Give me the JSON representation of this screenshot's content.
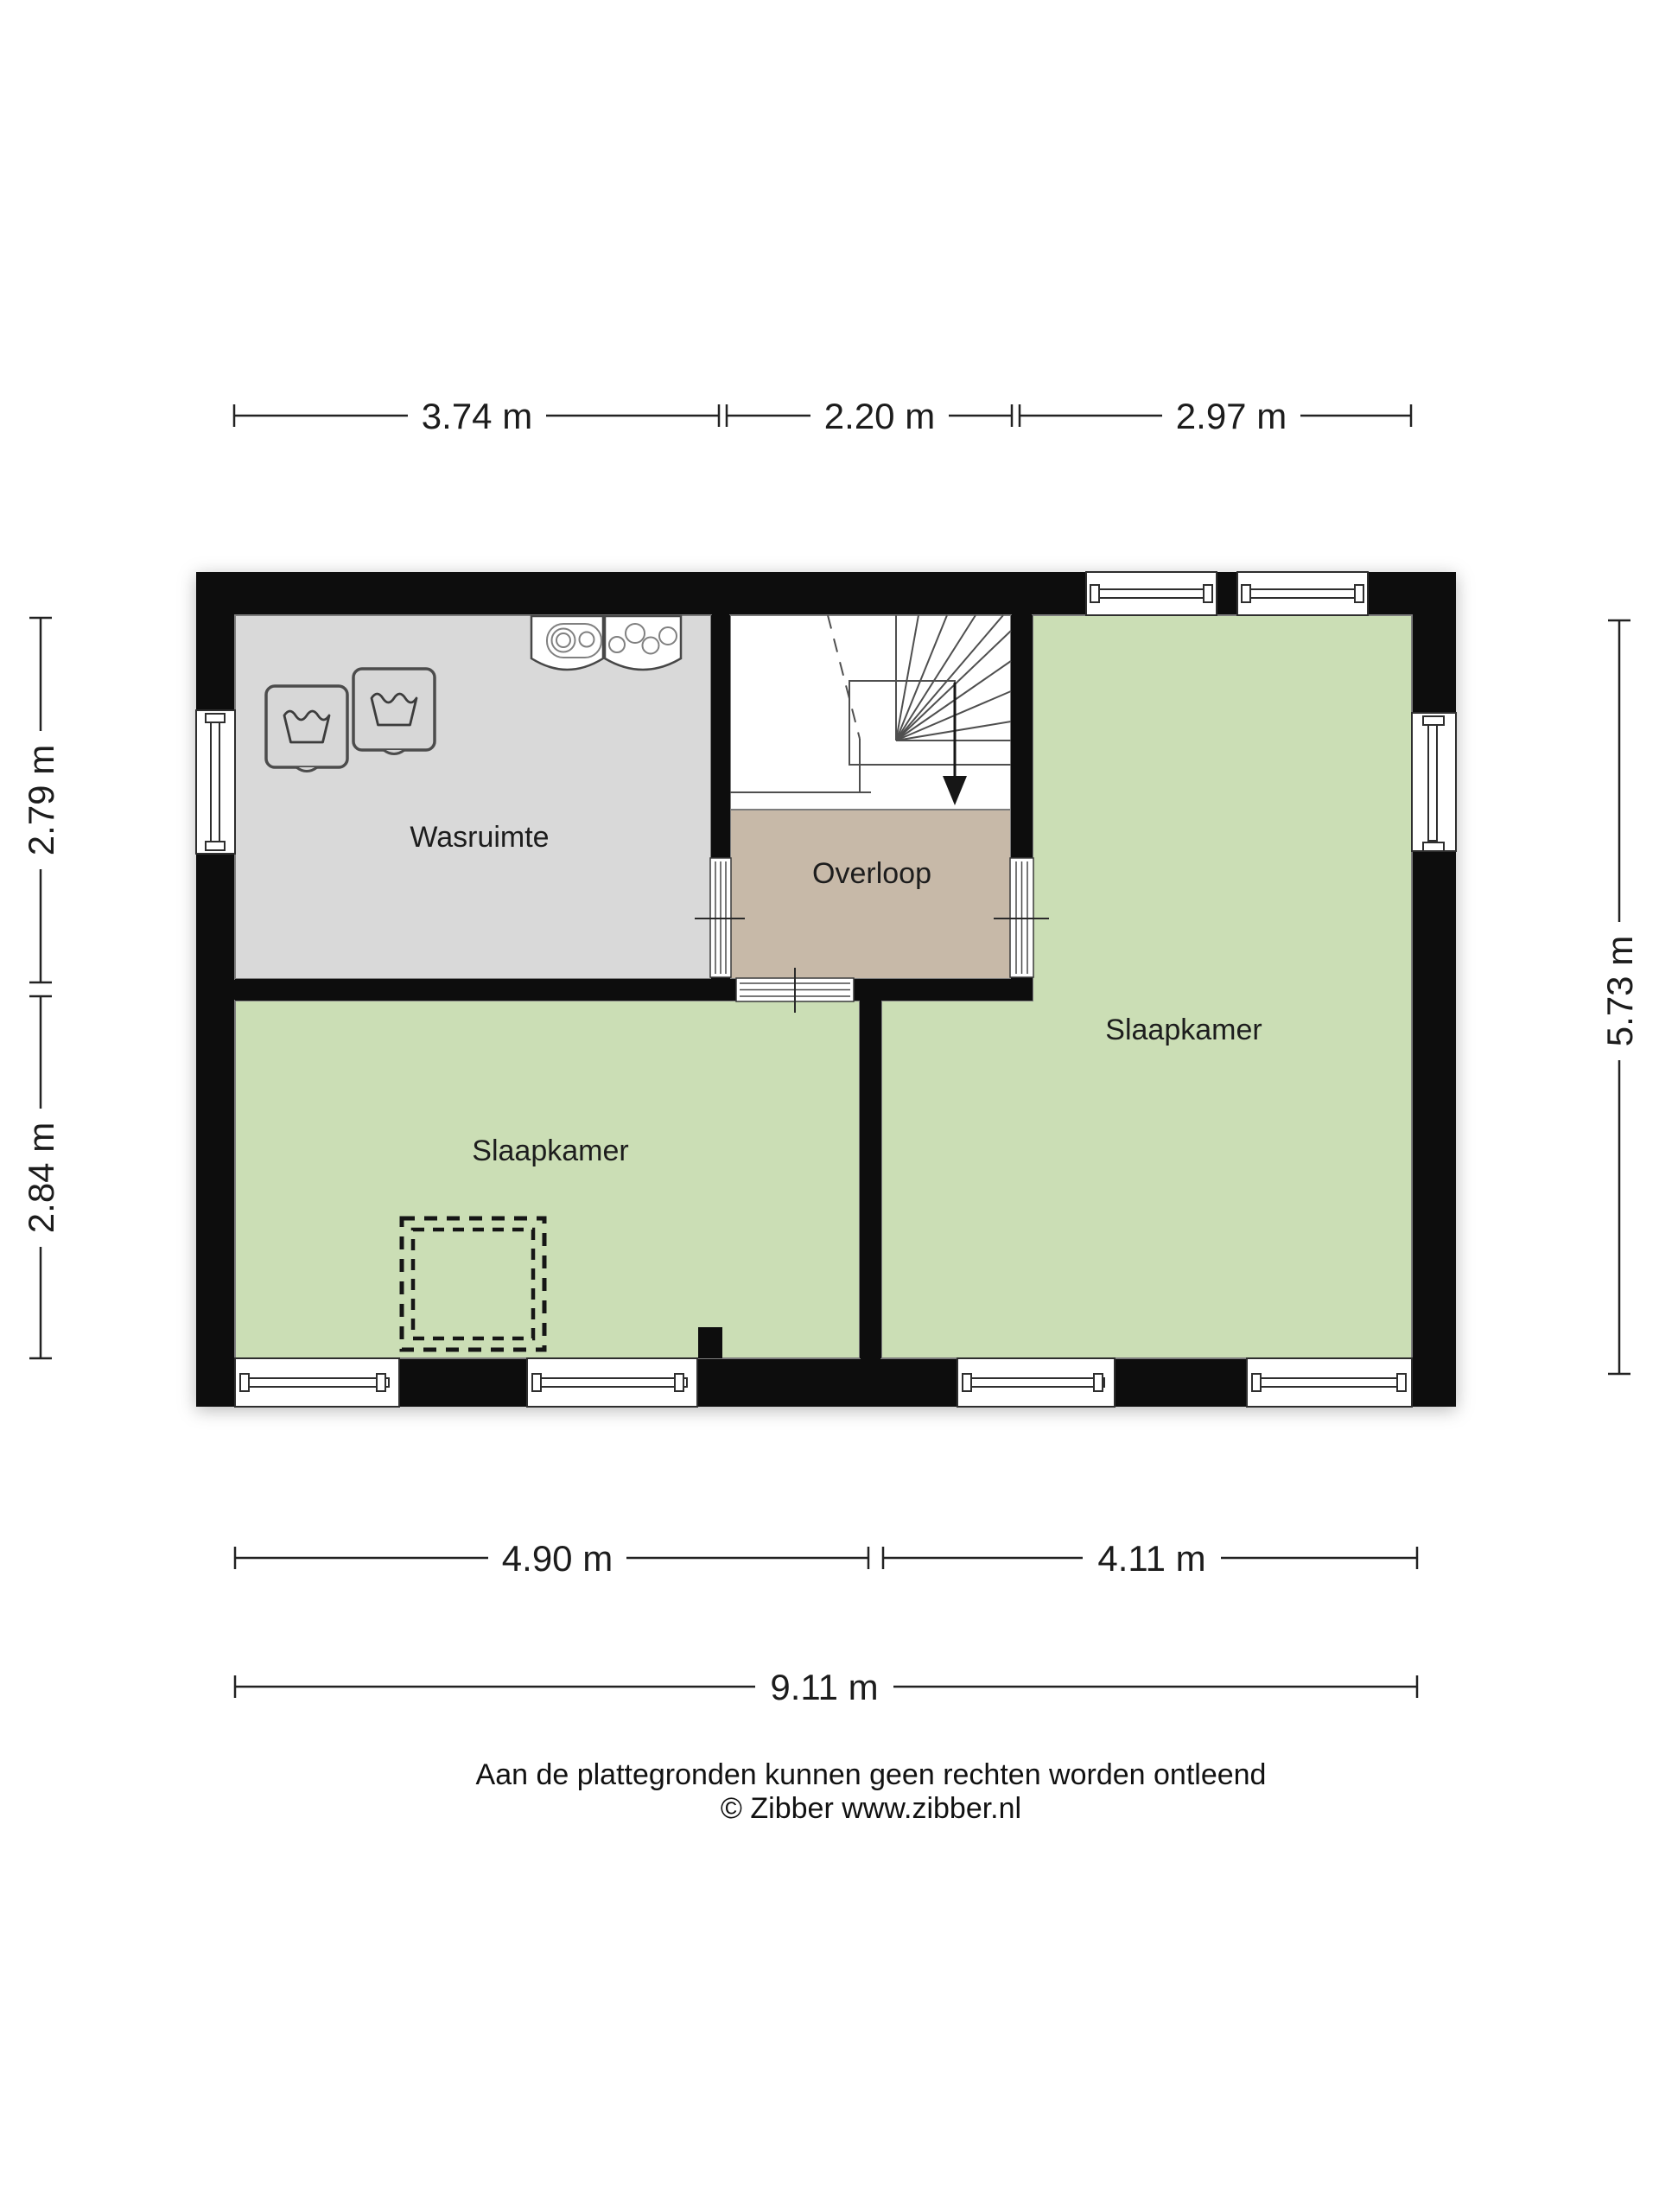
{
  "plan": {
    "rooms": {
      "wasruimte": {
        "label": "Wasruimte"
      },
      "overloop": {
        "label": "Overloop"
      },
      "slaapkamer_left": {
        "label": "Slaapkamer"
      },
      "slaapkamer_right": {
        "label": "Slaapkamer"
      }
    },
    "dimensions": {
      "top": [
        "3.74 m",
        "2.20 m",
        "2.97 m"
      ],
      "left": [
        "2.79 m",
        "2.84 m"
      ],
      "right": [
        "5.73 m"
      ],
      "bottom": [
        "4.90 m",
        "4.11 m"
      ],
      "overall_width": "9.11 m"
    },
    "colors": {
      "wall": "#0d0d0d",
      "wasruimte_floor": "#d9d9d9",
      "overloop_floor": "#c7b9a8",
      "bedroom_floor": "#cbdeb5",
      "stairwell_floor": "#ffffff"
    },
    "icons": [
      "washing-machine-icon",
      "washing-machine-icon",
      "boiler-icon",
      "heater-icon",
      "stairs-down-arrow-icon",
      "vide-dashed-opening"
    ]
  },
  "footer": {
    "disclaimer": "Aan de plattegronden kunnen geen rechten worden ontleend",
    "credit": "© Zibber www.zibber.nl"
  }
}
